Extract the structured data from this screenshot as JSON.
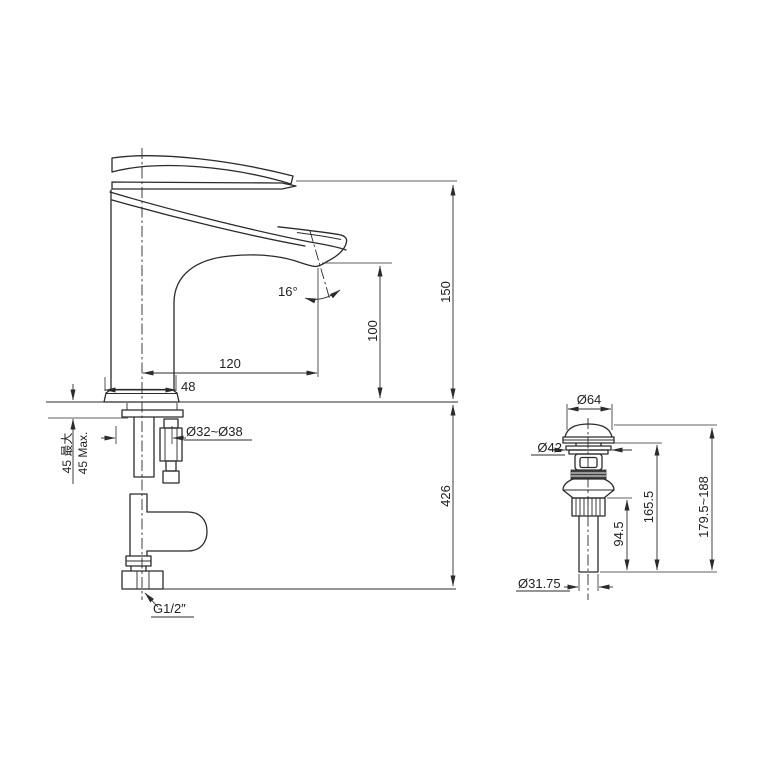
{
  "colors": {
    "line": "#2b2b2b",
    "background": "#ffffff"
  },
  "faucet_view": {
    "spout_height": "150",
    "outlet_height": "100",
    "spout_reach": "120",
    "base_width": "48",
    "outlet_angle": "16°",
    "deck_thickness_cn": "45 最大",
    "deck_thickness_en": "45 Max.",
    "mounting_hole": "Ø32~Ø38",
    "below_deck_length": "426",
    "inlet_thread": "G1/2″"
  },
  "drain_view": {
    "cap_diameter": "Ø64",
    "flange_diameter": "Ø42",
    "overall_length": "179.5~188",
    "body_length": "165.5",
    "tail_length": "94.5",
    "tail_diameter": "Ø31.75"
  }
}
